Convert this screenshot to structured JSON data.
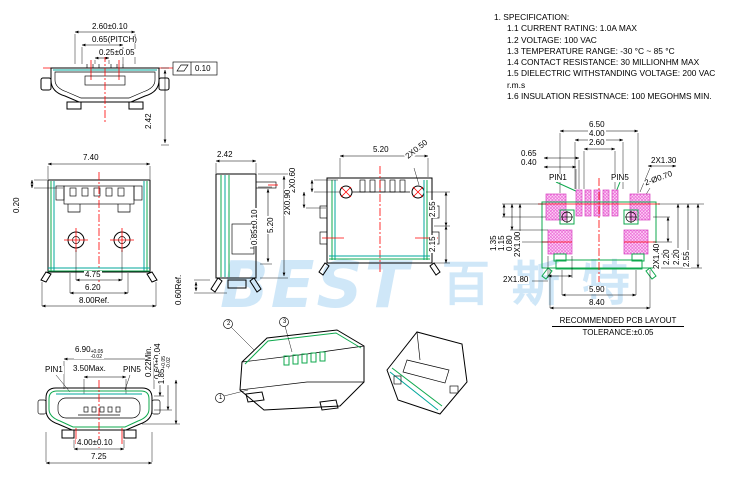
{
  "spec": {
    "title": "1. SPECIFICATION:",
    "items": [
      "1.1  CURRENT RATING: 1.0A MAX",
      "1.2  VOLTAGE: 100 VAC",
      "1.3  TEMPERATURE RANGE: -30 °C ~ 85 °C",
      "1.4  CONTACT RESISTANCE: 30 MILLIONHM MAX",
      "1.5  DIELECTRIC WITHSTANDING VOLTAGE: 200 VAC r.m.s",
      "1.6  INSULATION RESISTNACE: 100 MEGOHMS MIN."
    ]
  },
  "watermark": {
    "latin": "BEST",
    "cjk": "百斯特"
  },
  "front_view": {
    "dim_width": "2.60±0.10",
    "dim_pitch": "0.65(PITCH)",
    "dim_contact": "0.25±0.05",
    "flatness_value": "0.10",
    "dim_height": "2.42"
  },
  "top_view": {
    "dim_width": "7.40",
    "dim_offset": "0.20",
    "dim_posts": "4.75",
    "dim_body": "6.20",
    "dim_ref": "8.00Ref."
  },
  "side_view": {
    "dim_width": "2.42",
    "dim_tab": "0.85±0.10",
    "dim_height": "5.20",
    "dim_ref": "0.60Ref."
  },
  "bottom_view": {
    "dim_slots": "2X0.60",
    "dim_width": "5.20",
    "dim_holes": "2X0.50",
    "dim_side": "2X0.90",
    "dim_upper": "2.55",
    "dim_lower": "2.15"
  },
  "pcb_layout": {
    "dim_span": "6.50",
    "dim_inner_span": "4.00",
    "dim_pad_span": "2.60",
    "dim_pitch": "0.65",
    "dim_pad_width": "0.40",
    "dim_shell_pad": "2X1.30",
    "dim_holes": "2-Ø0.70",
    "pin1": "PIN1",
    "pin5": "PIN5",
    "dim_left_a": "1.35",
    "dim_left_b": "1.15",
    "dim_left_c": "0.80",
    "dim_left_d": "2X1.00",
    "dim_lower_pad": "2X1.80",
    "dim_feet": "5.90",
    "dim_overall": "8.40",
    "dim_right_a": "2X1.40",
    "dim_right_b": "2.20",
    "dim_right_c": "2.20",
    "dim_right_d": "2.55",
    "title": "RECOMMENDED PCB LAYOUT",
    "tolerance": "TOLERANCE:±0.05"
  },
  "mating_view": {
    "dim_width": "6.90",
    "dim_width_sup": "+0.05",
    "dim_width_sub": "-0.02",
    "pin1": "PIN1",
    "pin5": "PIN5",
    "dim_max": "3.50Max.",
    "dim_r_a": "0.22Min.",
    "dim_r_b": "0.60±0.04",
    "dim_r_c": "1.85",
    "dim_r_c_sup": "+0.05",
    "dim_r_c_sub": "-0.02",
    "dim_feet": "4.00±0.10",
    "dim_overall": "7.25"
  },
  "iso": {
    "callout_a": "2",
    "callout_b": "3",
    "callout_c": "1"
  }
}
